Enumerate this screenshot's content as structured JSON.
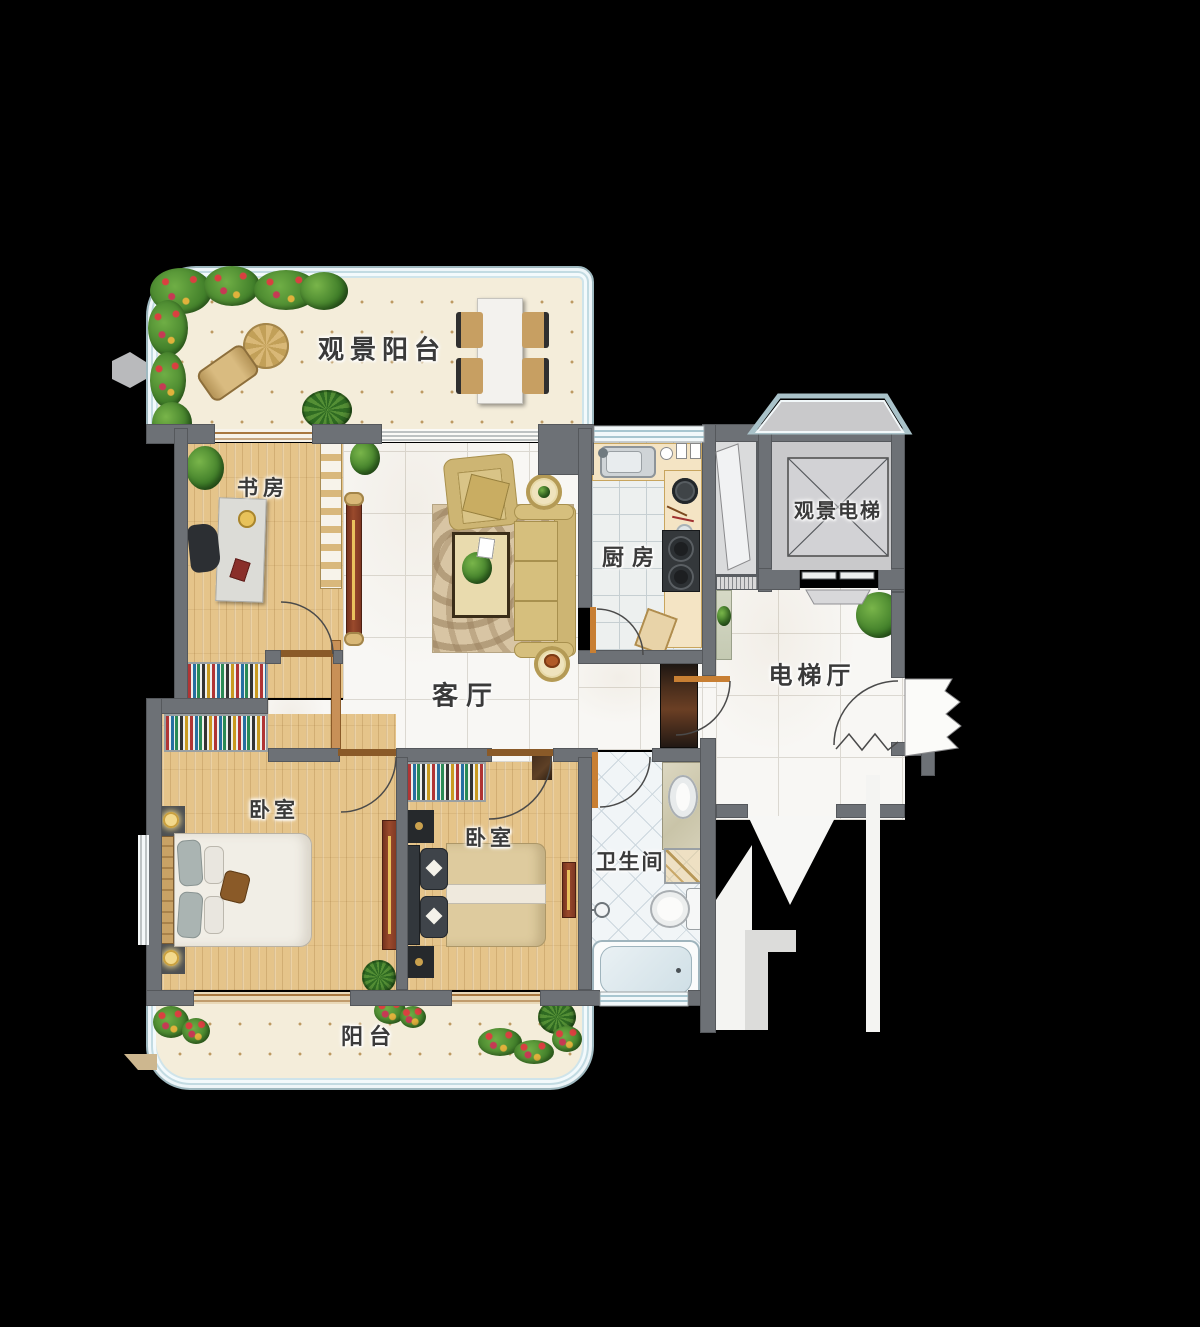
{
  "rooms": {
    "view_balcony": {
      "label": "观景阳台"
    },
    "study": {
      "label": "书房"
    },
    "living": {
      "label": "客厅"
    },
    "kitchen": {
      "label": "厨房"
    },
    "view_elevator": {
      "label": "观景电梯"
    },
    "elevator_hall": {
      "label": "电梯厅"
    },
    "bedroom_left": {
      "label": "卧室"
    },
    "bedroom_right": {
      "label": "卧室"
    },
    "bathroom": {
      "label": "卫生间"
    },
    "balcony": {
      "label": "阳台"
    }
  },
  "colors": {
    "background": "#000000",
    "wall": "#6d7176",
    "wood_floor": "#e5c48a",
    "marble": "#f8f7f4",
    "balcony_floor": "#f4edda",
    "counter": "#f4e4c4",
    "elevator_shaft": "#c9c9cb",
    "accent_cabinet_red": "#8a3f26",
    "gold": "#d8ab4f",
    "window_line": "#a9c2c9",
    "plant_green": "#3e7c28"
  }
}
